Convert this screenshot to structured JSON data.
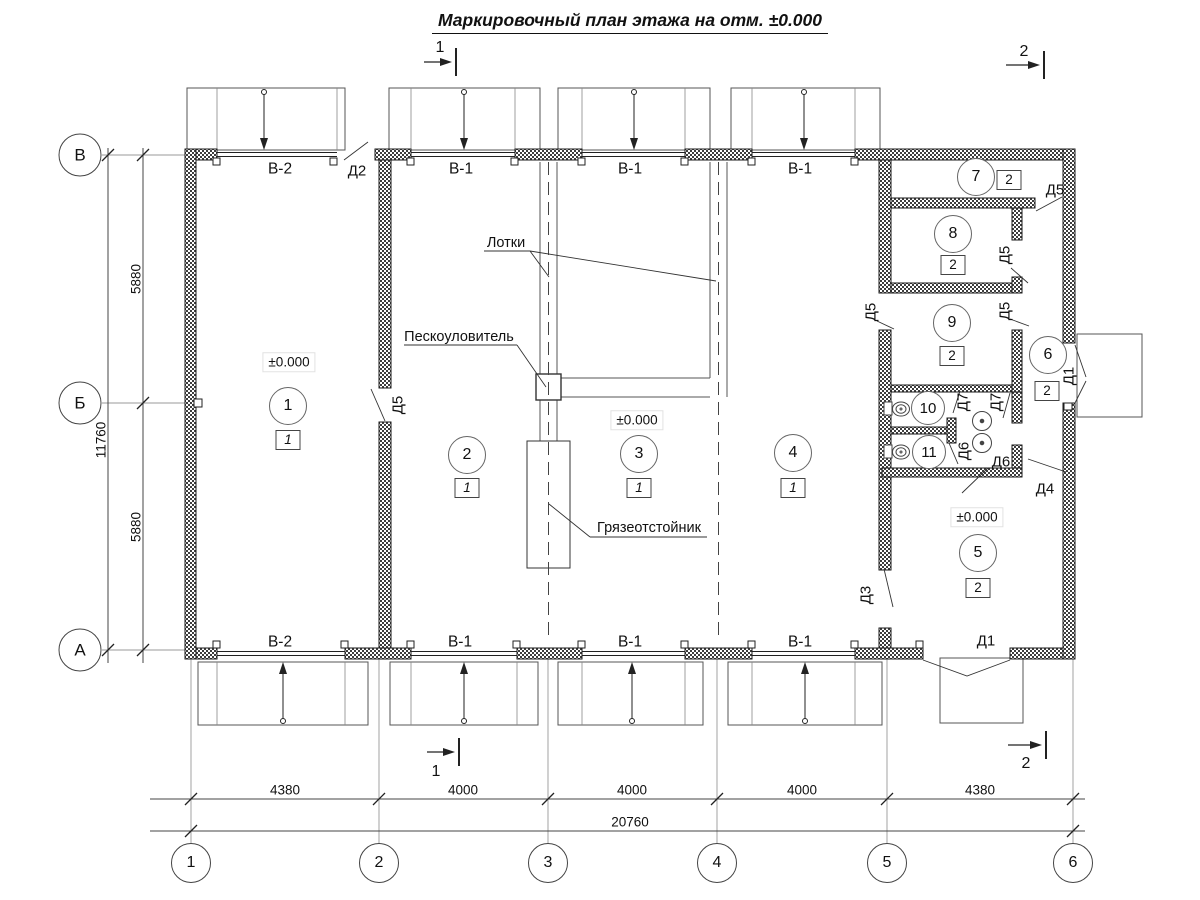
{
  "title": {
    "text": "Маркировочный план этажа на отм. ±0.000"
  },
  "section_marks": [
    {
      "label": "1",
      "x": 440,
      "y": 48
    },
    {
      "label": "2",
      "x": 1024,
      "y": 52
    },
    {
      "label": "1",
      "x": 436,
      "y": 772
    },
    {
      "label": "2",
      "x": 1026,
      "y": 764
    }
  ],
  "grid_axes": {
    "vertical": [
      {
        "label": "1",
        "x": 191
      },
      {
        "label": "2",
        "x": 379
      },
      {
        "label": "3",
        "x": 548
      },
      {
        "label": "4",
        "x": 717
      },
      {
        "label": "5",
        "x": 887
      },
      {
        "label": "6",
        "x": 1073
      }
    ],
    "horizontal": [
      {
        "label": "В",
        "y": 155
      },
      {
        "label": "Б",
        "y": 403
      },
      {
        "label": "А",
        "y": 650
      }
    ]
  },
  "dimensions": {
    "bottom": [
      {
        "value": "4380",
        "x": 285
      },
      {
        "value": "4000",
        "x": 463
      },
      {
        "value": "4000",
        "x": 632
      },
      {
        "value": "4000",
        "x": 802
      },
      {
        "value": "4380",
        "x": 980
      }
    ],
    "bottom_total": {
      "value": "20760",
      "x": 630
    },
    "left": [
      {
        "value": "5880",
        "y": 279
      },
      {
        "value": "5880",
        "y": 527
      }
    ],
    "left_total": {
      "value": "11760",
      "y": 440
    }
  },
  "gate_labels": [
    {
      "text": "В-2",
      "x": 280,
      "y": 169
    },
    {
      "text": "В-1",
      "x": 461,
      "y": 169
    },
    {
      "text": "В-1",
      "x": 630,
      "y": 169
    },
    {
      "text": "В-1",
      "x": 800,
      "y": 169
    },
    {
      "text": "В-2",
      "x": 280,
      "y": 642
    },
    {
      "text": "В-1",
      "x": 460,
      "y": 642
    },
    {
      "text": "В-1",
      "x": 630,
      "y": 642
    },
    {
      "text": "В-1",
      "x": 800,
      "y": 642
    }
  ],
  "door_labels": [
    {
      "text": "Д2",
      "x": 357,
      "y": 171,
      "rot": 0
    },
    {
      "text": "Д5",
      "x": 398,
      "y": 405,
      "rot": -90
    },
    {
      "text": "Д5",
      "x": 1055,
      "y": 190,
      "rot": 0
    },
    {
      "text": "Д5",
      "x": 1005,
      "y": 255,
      "rot": -90
    },
    {
      "text": "Д5",
      "x": 871,
      "y": 312,
      "rot": -90
    },
    {
      "text": "Д5",
      "x": 1005,
      "y": 311,
      "rot": -90
    },
    {
      "text": "Д7",
      "x": 963,
      "y": 402,
      "rot": -90
    },
    {
      "text": "Д7",
      "x": 996,
      "y": 402,
      "rot": -90
    },
    {
      "text": "Д6",
      "x": 964,
      "y": 451,
      "rot": -90
    },
    {
      "text": "Д6",
      "x": 1001,
      "y": 462,
      "rot": 0
    },
    {
      "text": "Д4",
      "x": 1045,
      "y": 489,
      "rot": 0
    },
    {
      "text": "Д3",
      "x": 866,
      "y": 595,
      "rot": -90
    },
    {
      "text": "Д1",
      "x": 1069,
      "y": 376,
      "rot": -90
    },
    {
      "text": "Д1",
      "x": 986,
      "y": 641,
      "rot": 0
    }
  ],
  "rooms": [
    {
      "number": "1",
      "category": "1",
      "italic": true,
      "cx": 288,
      "cy": 406,
      "bx": 288,
      "by": 440
    },
    {
      "number": "2",
      "category": "1",
      "italic": true,
      "cx": 467,
      "cy": 455,
      "bx": 467,
      "by": 488
    },
    {
      "number": "3",
      "category": "1",
      "italic": true,
      "cx": 639,
      "cy": 454,
      "bx": 639,
      "by": 488
    },
    {
      "number": "4",
      "category": "1",
      "italic": true,
      "cx": 793,
      "cy": 453,
      "bx": 793,
      "by": 488
    },
    {
      "number": "5",
      "category": "2",
      "italic": false,
      "cx": 978,
      "cy": 553,
      "bx": 978,
      "by": 588
    },
    {
      "number": "6",
      "category": "2",
      "italic": false,
      "cx": 1048,
      "cy": 355,
      "bx": 1047,
      "by": 391
    },
    {
      "number": "7",
      "category": "2",
      "italic": false,
      "cx": 976,
      "cy": 177,
      "bx": 1009,
      "by": 180
    },
    {
      "number": "8",
      "category": "2",
      "italic": false,
      "cx": 953,
      "cy": 234,
      "bx": 953,
      "by": 265
    },
    {
      "number": "9",
      "category": "2",
      "italic": false,
      "cx": 952,
      "cy": 323,
      "bx": 952,
      "by": 356
    },
    {
      "number": "10",
      "small": true,
      "cx": 928,
      "cy": 408
    },
    {
      "number": "11",
      "small": true,
      "cx": 929,
      "cy": 452
    }
  ],
  "elevation_marks": [
    {
      "text": "±0.000",
      "x": 289,
      "y": 362
    },
    {
      "text": "±0.000",
      "x": 637,
      "y": 420
    },
    {
      "text": "±0.000",
      "x": 977,
      "y": 517
    }
  ],
  "annotations": [
    {
      "key": "trays",
      "text": "Лотки",
      "x": 506,
      "y": 243
    },
    {
      "key": "sand-trap",
      "text": "Пескоуловитель",
      "x": 459,
      "y": 337
    },
    {
      "key": "mud-settler",
      "text": "Грязеотстойник",
      "x": 649,
      "y": 528
    }
  ]
}
